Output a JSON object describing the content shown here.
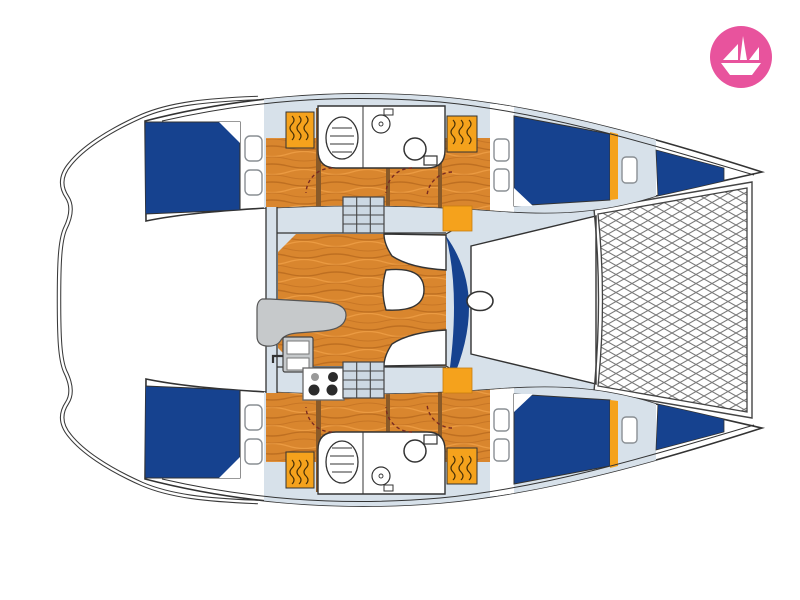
{
  "page": {
    "background": "#ffffff"
  },
  "logo": {
    "icon": "paper-boat-icon",
    "background_color": "#e8539d",
    "foreground_color": "#ffffff"
  },
  "palette": {
    "outline": "#333333",
    "deck": "#d7e1ea",
    "cushion_blue": "#16428f",
    "wood_base": "#d9862e",
    "wood_grain_dark": "#b5661c",
    "wood_grain_light": "#ef9f45",
    "locker_orange": "#f5a21c",
    "counter_gray": "#c6c9cb",
    "stair_fill": "#ccd8e3",
    "door_arc": "#7a2b20",
    "mesh_line": "#7a7a7a",
    "white": "#ffffff"
  },
  "plan": {
    "type": "diagram",
    "subject": "catamaran-interior-floor-plan",
    "orientation": "bow-right",
    "features": [
      "stern-platform",
      "cockpit",
      "aft-cabin-bed-port",
      "aft-cabin-bed-starboard",
      "bathroom-port",
      "bathroom-starboard",
      "shower-basin",
      "toilet",
      "washbasin",
      "wardrobe-lockers",
      "saloon",
      "galley-counter",
      "galley-sink",
      "stove",
      "companionway-stairs-port",
      "companionway-stairs-starboard",
      "chart-table",
      "dinette-seating",
      "dinette-table",
      "seat-backrest",
      "forward-cabin-bed-port",
      "forward-cabin-bed-starboard",
      "forepeak-port",
      "forepeak-starboard",
      "foredeck",
      "mast-base",
      "trampoline-net",
      "bow-port",
      "bow-starboard",
      "hatches"
    ]
  }
}
